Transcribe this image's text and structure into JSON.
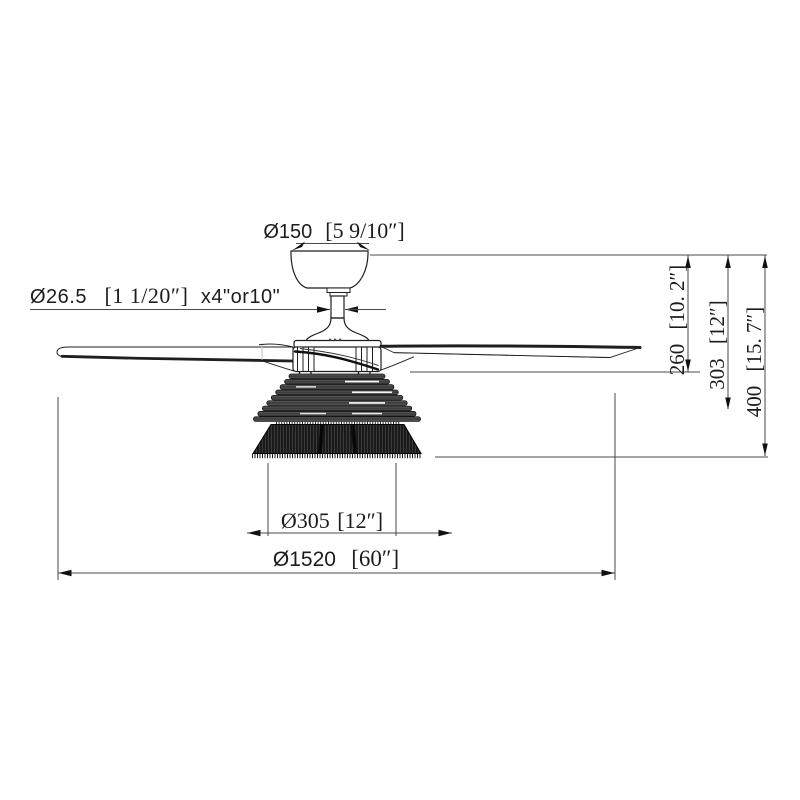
{
  "drawing": {
    "type": "ceiling-fan-dimension-diagram",
    "labels": {
      "canopy_diameter": {
        "metric": "Ø150",
        "imperial": "[5 9/10″]"
      },
      "downrod": {
        "metric": "Ø26.5",
        "imperial": "[1 1/20″]",
        "length_options": "x4\"or10\""
      },
      "ceiling_to_blades": {
        "metric": "260",
        "imperial": "[10. 2″]"
      },
      "ceiling_to_light": {
        "metric": "303",
        "imperial": "[12″]"
      },
      "total_height": {
        "metric": "400",
        "imperial": "[15. 7″]"
      },
      "shade_diameter": {
        "metric": "Ø305",
        "imperial": "[12″]"
      },
      "blade_sweep": {
        "metric": "Ø1520",
        "imperial": "[60″]"
      }
    },
    "colors": {
      "background": "#ffffff",
      "ink": "#1f1f1f",
      "dimension_line": "#4a4a4a",
      "slat_gray": "#4f4f4f",
      "grill_black": "#1a1a1a"
    }
  }
}
